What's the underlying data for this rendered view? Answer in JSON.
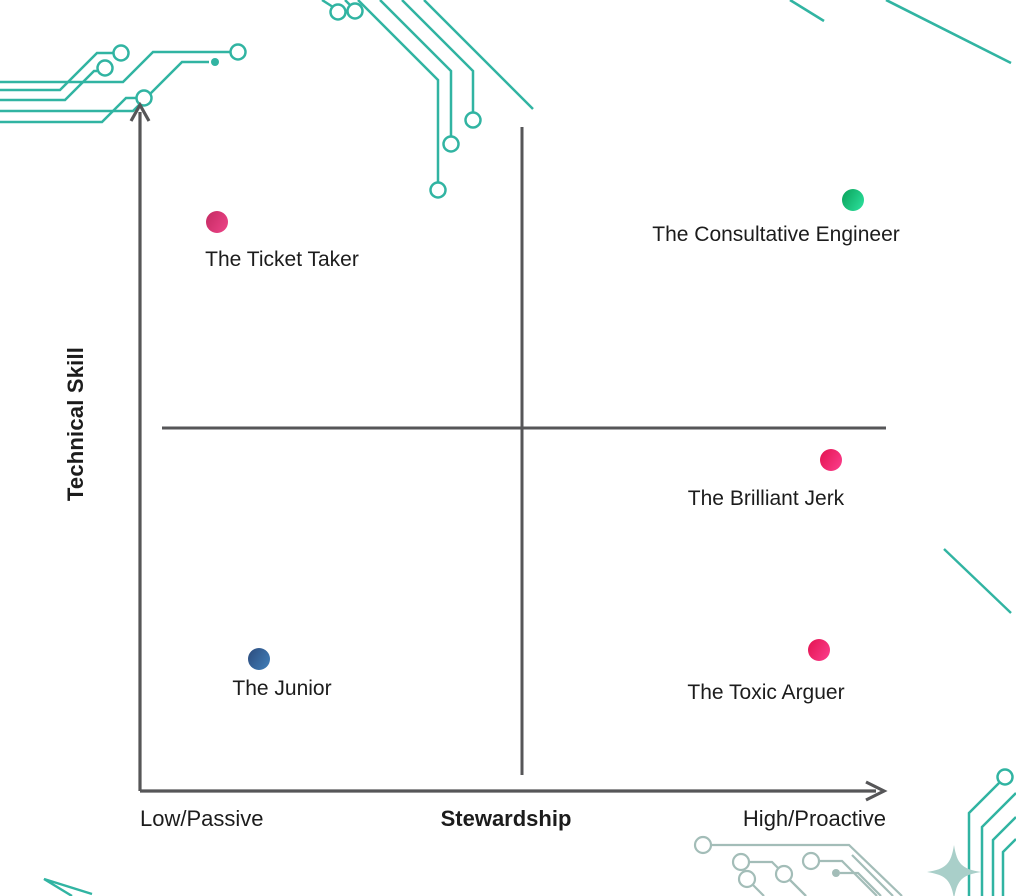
{
  "colors": {
    "background": "#ffffff",
    "axis": "#565658",
    "text": "#1c1c1c",
    "circuit_teal": "#31b4a2",
    "circuit_pale": "#a3bdb8",
    "sparkle_fill": "#a9cfc9",
    "dot_pink_from": "#c42a62",
    "dot_pink_to": "#ee4589",
    "dot_red_pink_from": "#e31350",
    "dot_red_pink_to": "#fc3f8e",
    "dot_green_from": "#09a159",
    "dot_green_to": "#2ee3a0",
    "dot_blue_from": "#2c4b7c",
    "dot_blue_to": "#4180bb"
  },
  "decorations": [
    "circuit-trace-top-left",
    "circuit-trace-top-middle",
    "diagonal-lines-top-right",
    "diagonal-line-right-middle",
    "circuit-trace-bottom-right-pale",
    "circuit-trace-bottom-right-teal",
    "sparkle-star-bottom-right",
    "bent-line-bottom-left"
  ],
  "chart_data": {
    "type": "scatter",
    "subtype": "quadrant-matrix",
    "title": "",
    "xlabel": "Stewardship",
    "ylabel": "Technical Skill",
    "x_left_label": "Low/Passive",
    "x_right_label": "High/Proactive",
    "grid": false,
    "legend": "none",
    "x_axis_semantics": [
      "Low/Passive",
      "High/Proactive"
    ],
    "y_axis_semantics": [
      "Low Technical Skill",
      "High Technical Skill"
    ],
    "points": [
      {
        "label": "The Ticket Taker",
        "stewardship": "low",
        "technical_skill": "high",
        "x_norm": 0.1,
        "y_norm": 0.83,
        "dot": {
          "x": 217,
          "y": 222,
          "color_from": "#c42a62",
          "color_to": "#ee4589"
        },
        "label_pos": {
          "x": 282,
          "y": 248
        }
      },
      {
        "label": "The Consultative Engineer",
        "stewardship": "high",
        "technical_skill": "high",
        "x_norm": 0.96,
        "y_norm": 0.86,
        "dot": {
          "x": 853,
          "y": 200,
          "color_from": "#09a159",
          "color_to": "#2ee3a0"
        },
        "label_pos": {
          "x": 776,
          "y": 223
        }
      },
      {
        "label": "The Brilliant Jerk",
        "stewardship": "high",
        "technical_skill": "medium-low",
        "x_norm": 0.93,
        "y_norm": 0.48,
        "dot": {
          "x": 831,
          "y": 460,
          "color_from": "#e31350",
          "color_to": "#fc3f8e"
        },
        "label_pos": {
          "x": 766,
          "y": 487
        }
      },
      {
        "label": "The Junior",
        "stewardship": "low",
        "technical_skill": "low",
        "x_norm": 0.16,
        "y_norm": 0.19,
        "dot": {
          "x": 259,
          "y": 659,
          "color_from": "#2c4b7c",
          "color_to": "#4180bb"
        },
        "label_pos": {
          "x": 282,
          "y": 677
        }
      },
      {
        "label": "The Toxic Arguer",
        "stewardship": "high",
        "technical_skill": "low",
        "x_norm": 0.91,
        "y_norm": 0.21,
        "dot": {
          "x": 819,
          "y": 650,
          "color_from": "#e31350",
          "color_to": "#fc3f8e"
        },
        "label_pos": {
          "x": 766,
          "y": 681
        }
      }
    ]
  }
}
